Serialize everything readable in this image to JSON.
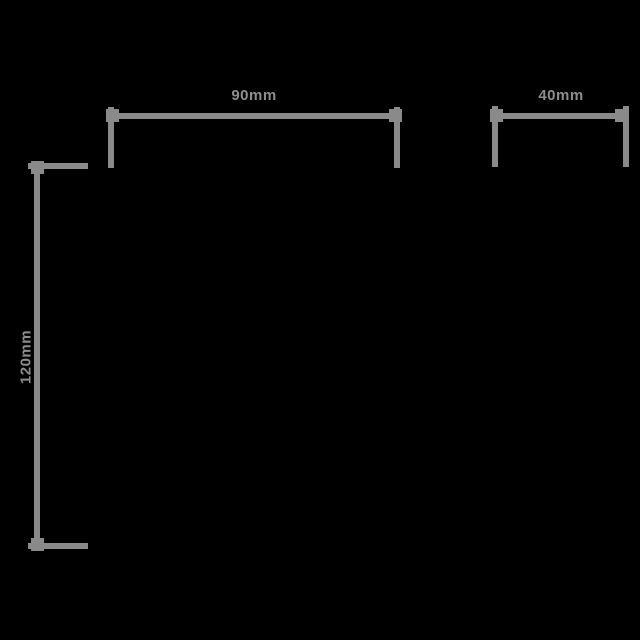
{
  "diagram": {
    "type": "product-dimension-drawing",
    "background_color": "#000000",
    "line_color": "#8a8a8a",
    "text_color": "#8d8d8d",
    "dimensions": {
      "top_width": {
        "label": "90mm",
        "orientation": "horizontal"
      },
      "side_width": {
        "label": "40mm",
        "orientation": "horizontal"
      },
      "height": {
        "label": "120mm",
        "orientation": "vertical"
      }
    }
  }
}
